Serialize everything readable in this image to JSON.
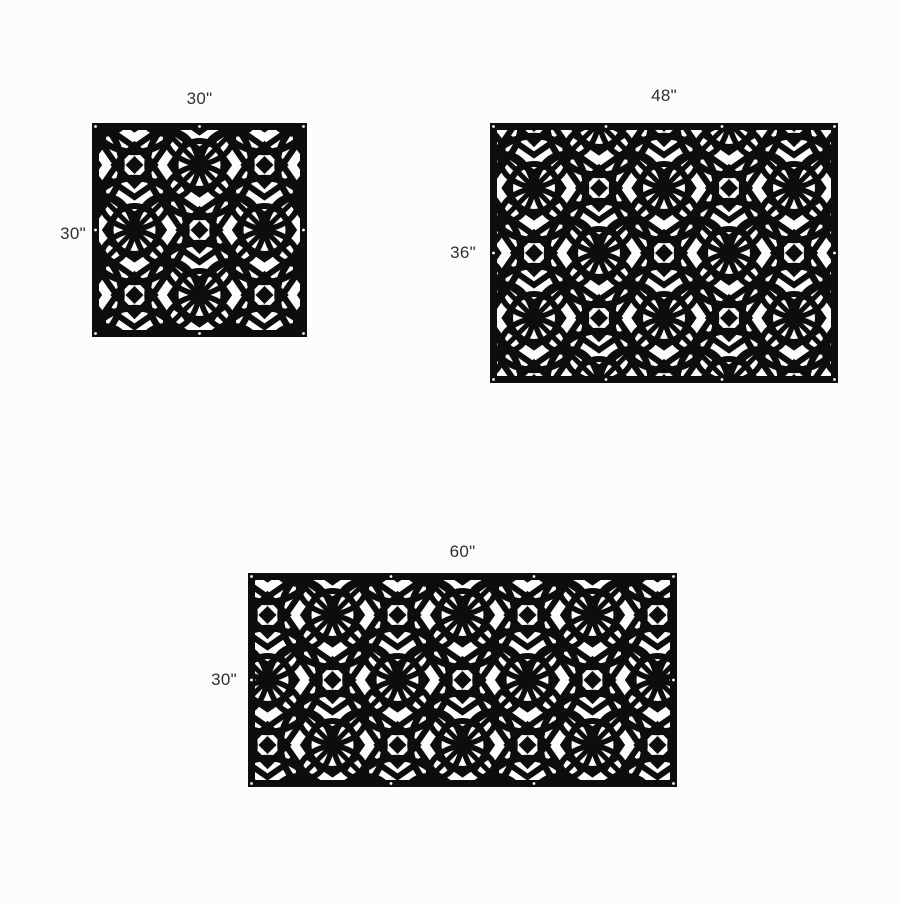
{
  "page": {
    "background_color": "#fcfcfc"
  },
  "style": {
    "panel_color": "#0d0d0d",
    "hole_color": "#ffffff",
    "label_color": "#303030",
    "pattern_motifs": [
      "overlapping-circles",
      "concentric-rings",
      "four-petal-flowers",
      "nested-chevrons",
      "diamonds",
      "diagonal-lattice"
    ]
  },
  "panels": [
    {
      "id": "panel-30x30",
      "width_label": "30\"",
      "height_label": "30\"",
      "width_inches": 30,
      "height_inches": 30
    },
    {
      "id": "panel-48x36",
      "width_label": "48\"",
      "height_label": "36\"",
      "width_inches": 48,
      "height_inches": 36
    },
    {
      "id": "panel-60x30",
      "width_label": "60\"",
      "height_label": "30\"",
      "width_inches": 60,
      "height_inches": 30
    }
  ]
}
